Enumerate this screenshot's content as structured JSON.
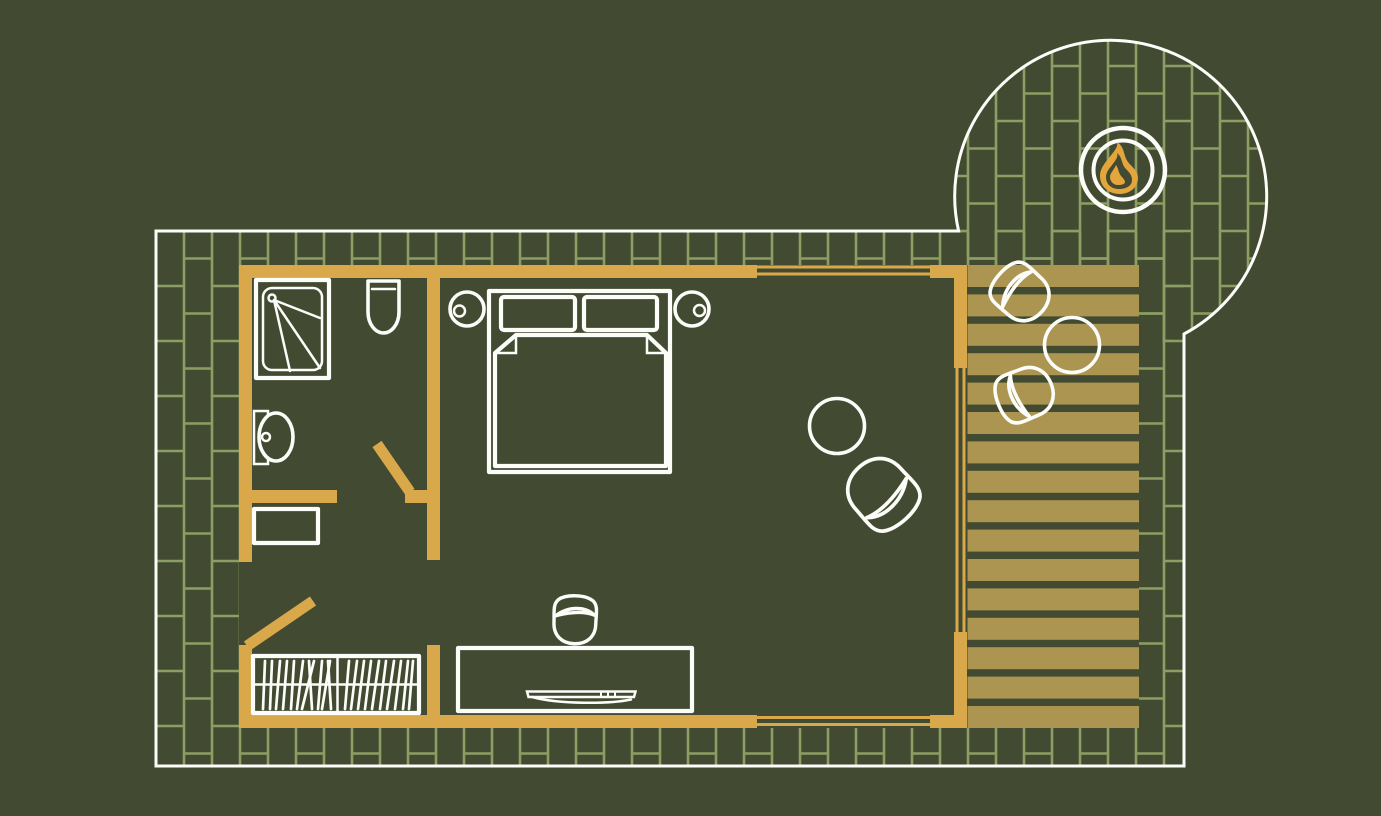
{
  "scene": {
    "type": "architectural floor plan",
    "subject": "Studio cabin floor plan with bathroom, bedroom, wardrobe, desk, lounge corner, wooden deck and circular brick patio with fire pit"
  },
  "colors": {
    "background": "#424B31",
    "brick_line": "#8C9E63",
    "wall": "#D9A84A",
    "deck_board": "#AB9550",
    "flame": "#E3A53C",
    "line": "#FCFCF9"
  },
  "site": {
    "paving": "brick pattern",
    "patio_shape": "circle",
    "fire_pit_icon": "fire-icon"
  },
  "objects": {
    "bathroom": [
      "shower",
      "toilet",
      "sink",
      "cabinet"
    ],
    "bedroom": [
      "double-bed",
      "pillow",
      "pillow",
      "nightstand",
      "nightstand",
      "wardrobe",
      "desk",
      "desk-chair",
      "laptop"
    ],
    "lounge": [
      "round-table",
      "armchair"
    ],
    "deck": [
      "deck-chair",
      "deck-chair",
      "round-table"
    ],
    "patio": [
      "fire-pit"
    ]
  },
  "details": {
    "deck_board_count": 16,
    "wardrobe_sections": 2,
    "window_count": 3,
    "door_count": 2
  }
}
